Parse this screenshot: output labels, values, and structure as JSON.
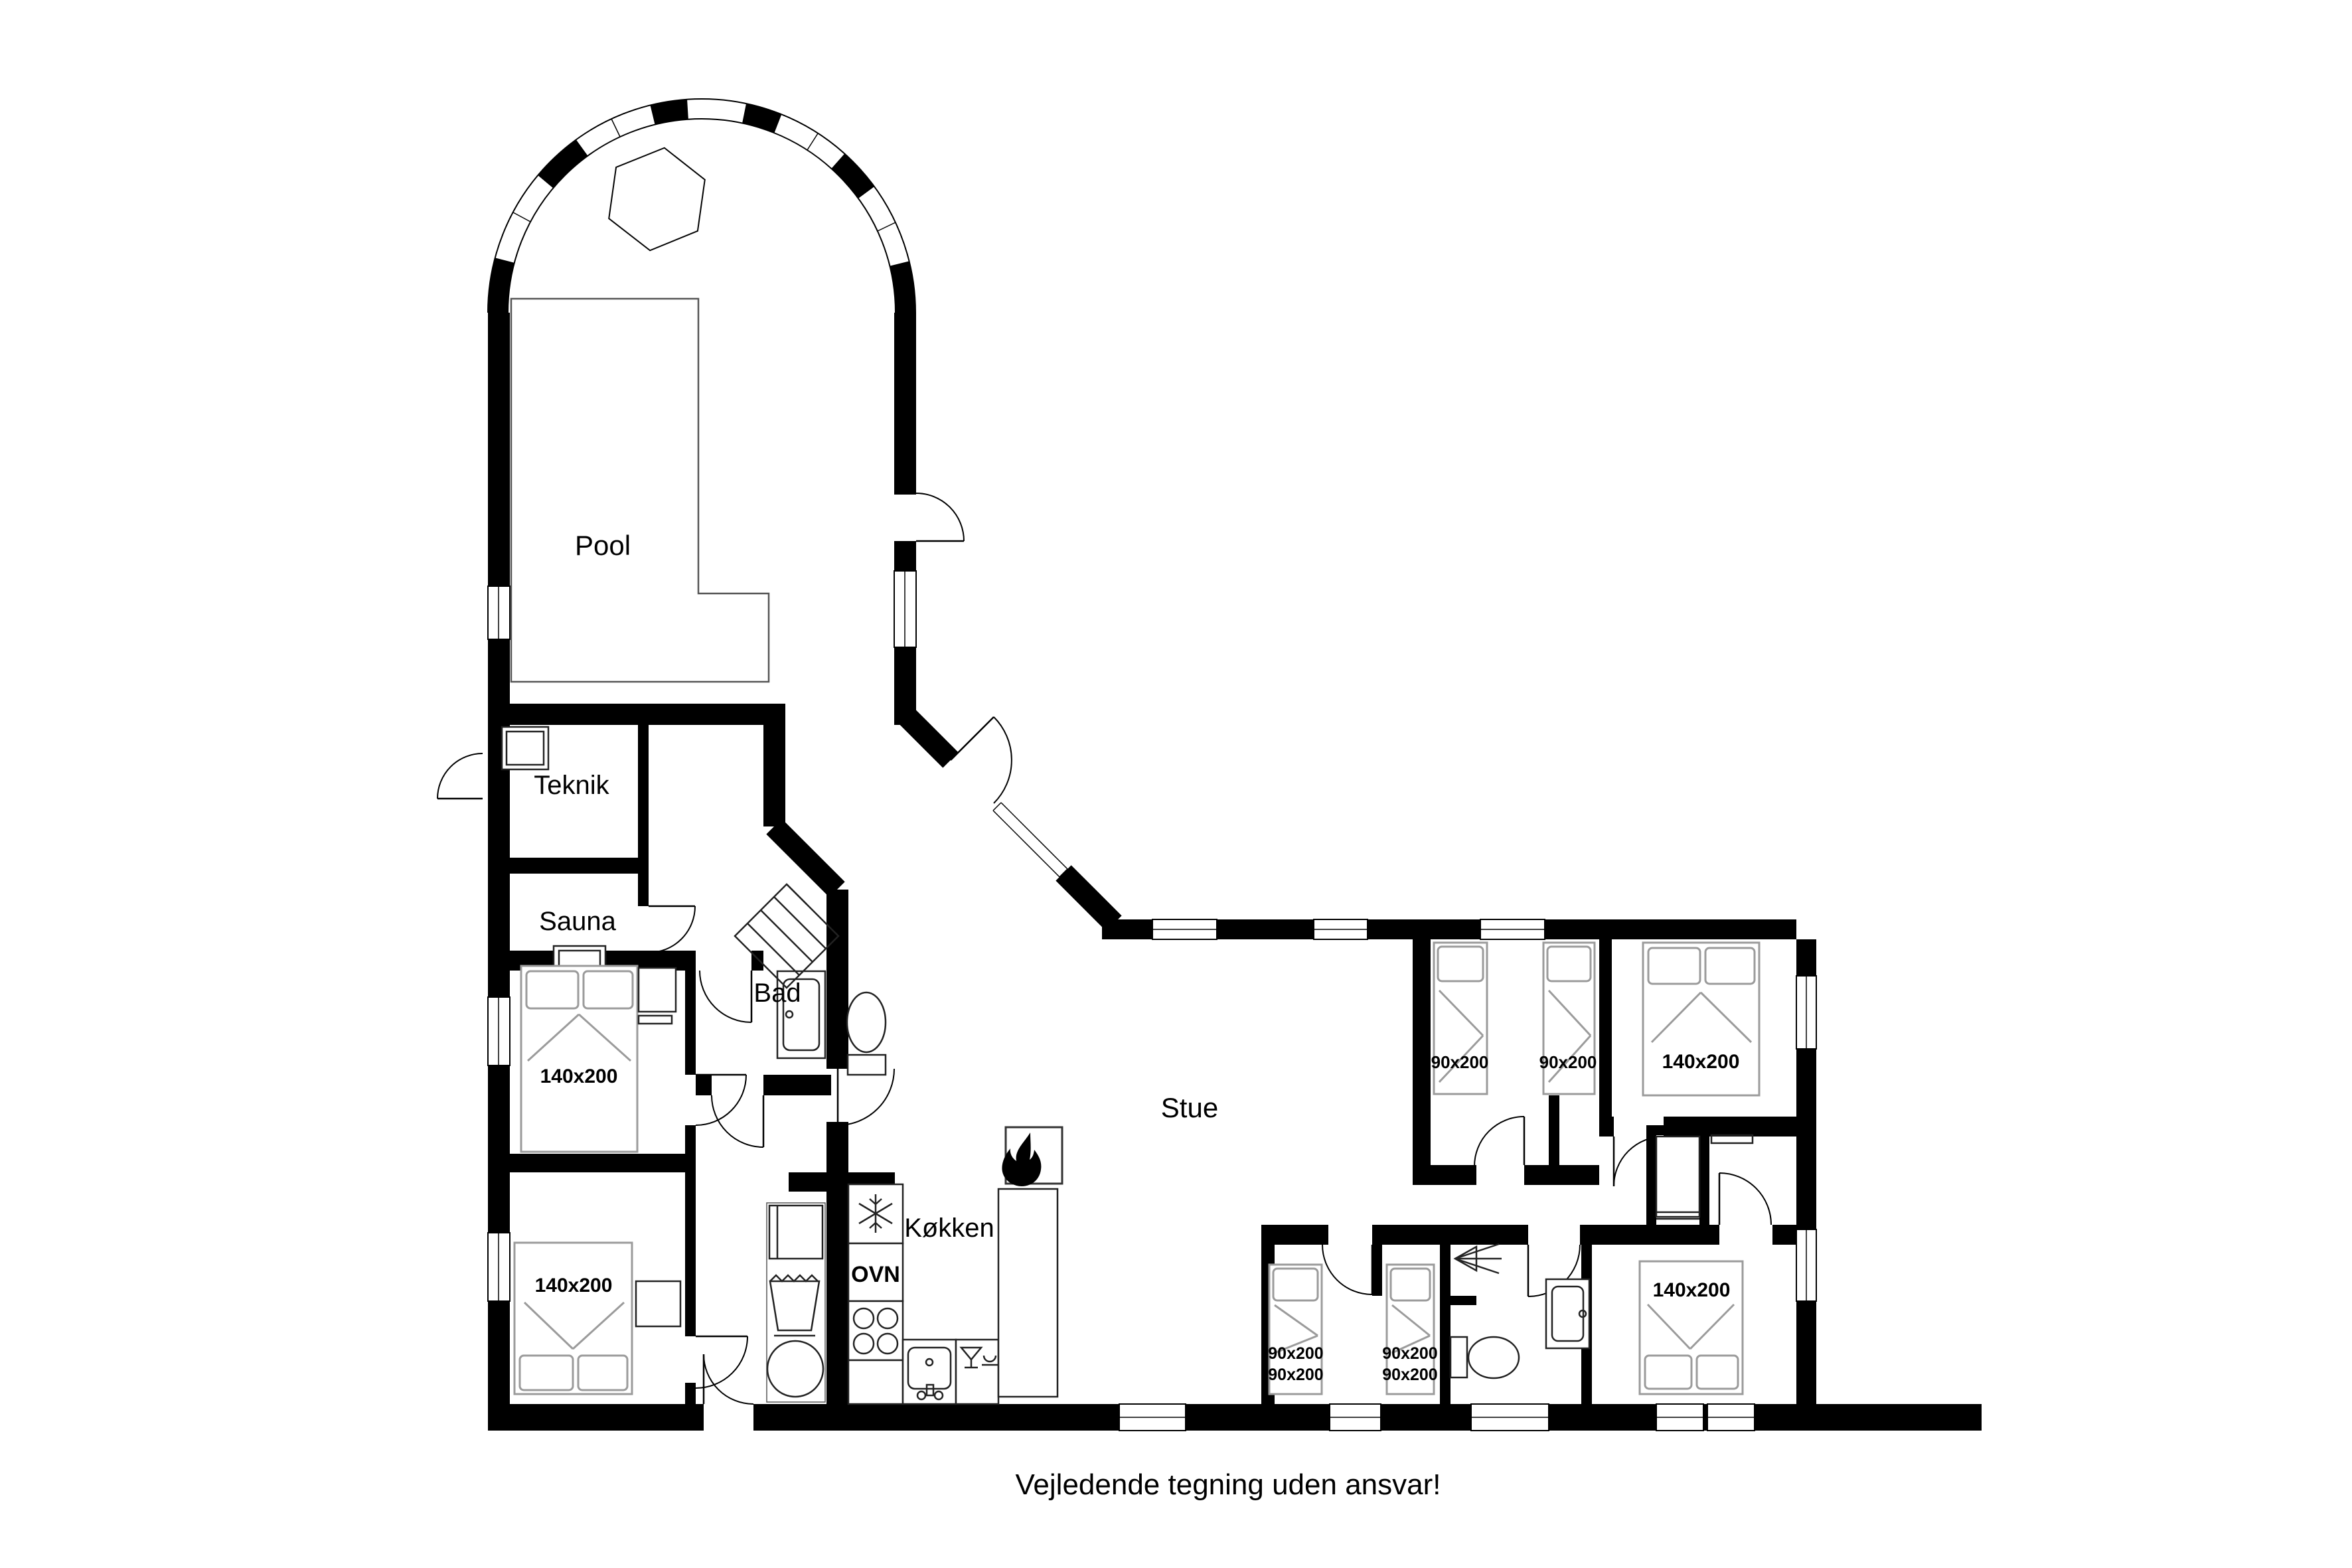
{
  "note": "Vejledende tegning uden ansvar!",
  "labels": {
    "pool": "Pool",
    "teknik": "Teknik",
    "sauna": "Sauna",
    "bad": "Bad",
    "stue": "Stue",
    "kokken": "Køkken",
    "oven": "OVN"
  },
  "bed_sizes": {
    "bedroom_left_1": "140x200",
    "bedroom_left_2": "140x200",
    "right_top_single_1": "90x200",
    "right_top_single_2": "90x200",
    "right_top_double": "140x200",
    "bunk_1_line1": "90x200",
    "bunk_1_line2": "90x200",
    "bunk_2_line1": "90x200",
    "bunk_2_line2": "90x200",
    "bedroom_right_bottom": "140x200"
  },
  "icons": {
    "fireplace": "flame-icon",
    "freezer": "snowflake-icon",
    "oven": "oven-unit",
    "cooktop": "four-burner-icon",
    "sink": "sink-icon",
    "bar": "glasses-icon",
    "washer": "washing-machine-icon",
    "laundry": "laundry-basket-icon",
    "shower": "shower-icon",
    "toilet": "toilet-icon",
    "sauna_heater": "sauna-heater-icon",
    "spa": "hexagon-spa-icon"
  },
  "colors": {
    "wall": "#000000",
    "furniture_line": "#9b9b9b",
    "background": "#ffffff"
  }
}
